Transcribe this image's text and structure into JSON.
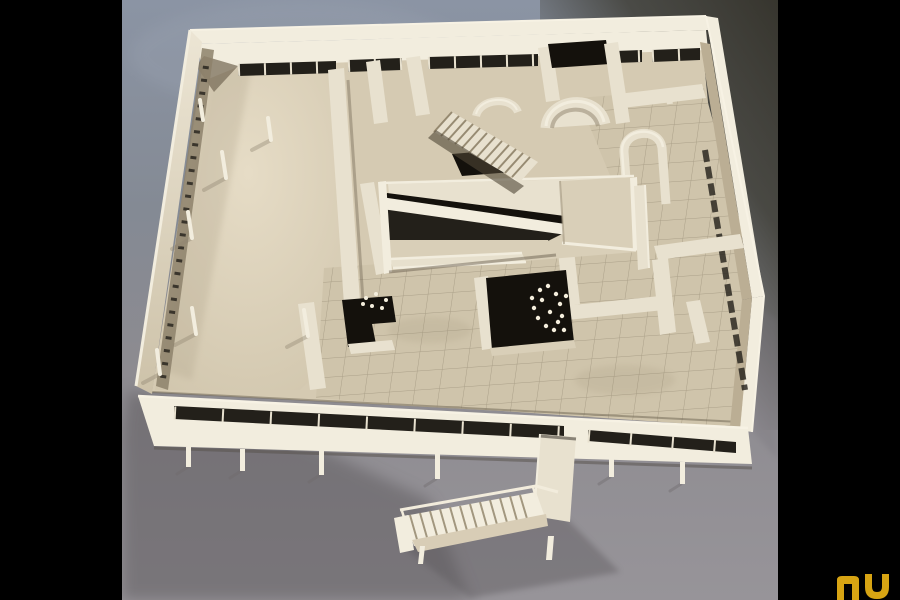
{
  "scene": {
    "alt": "Color photograph, seen from above: a white cut-away architectural model of a modernist villa (roof removed) showing an interior ramp over a dark void, two staircases, curved partition walls, ribbon windows and a tiled terrace. The model stands on thin pilotis on gray carpet; an exterior stair projects toward the viewer.",
    "letterbox": "black vertical bars left and right of the photograph"
  },
  "logo": {
    "label": "gold nu logo watermark, bottom-right corner, partly cropped",
    "letters": "nu"
  },
  "colors": {
    "letterbox": "#000000",
    "bg-top": "#8b94a4",
    "bg-upper": "#848a94",
    "bg-lower": "#8d8b90",
    "carpet": "#979499",
    "dark-corner": "#3a382f",
    "shadow": "#5c585c",
    "model-bright": "#f2edde",
    "model-light": "#e8e1cf",
    "model-cream": "#d9cfb8",
    "model-floor": "#d5cab2",
    "model-tile": "#cfc4ab",
    "model-tan": "#bbae94",
    "model-deep": "#8d816b",
    "void": "#14110c",
    "window": "#23201a",
    "grid-line": "#6f6450",
    "logo-gold": "#d7a413"
  }
}
